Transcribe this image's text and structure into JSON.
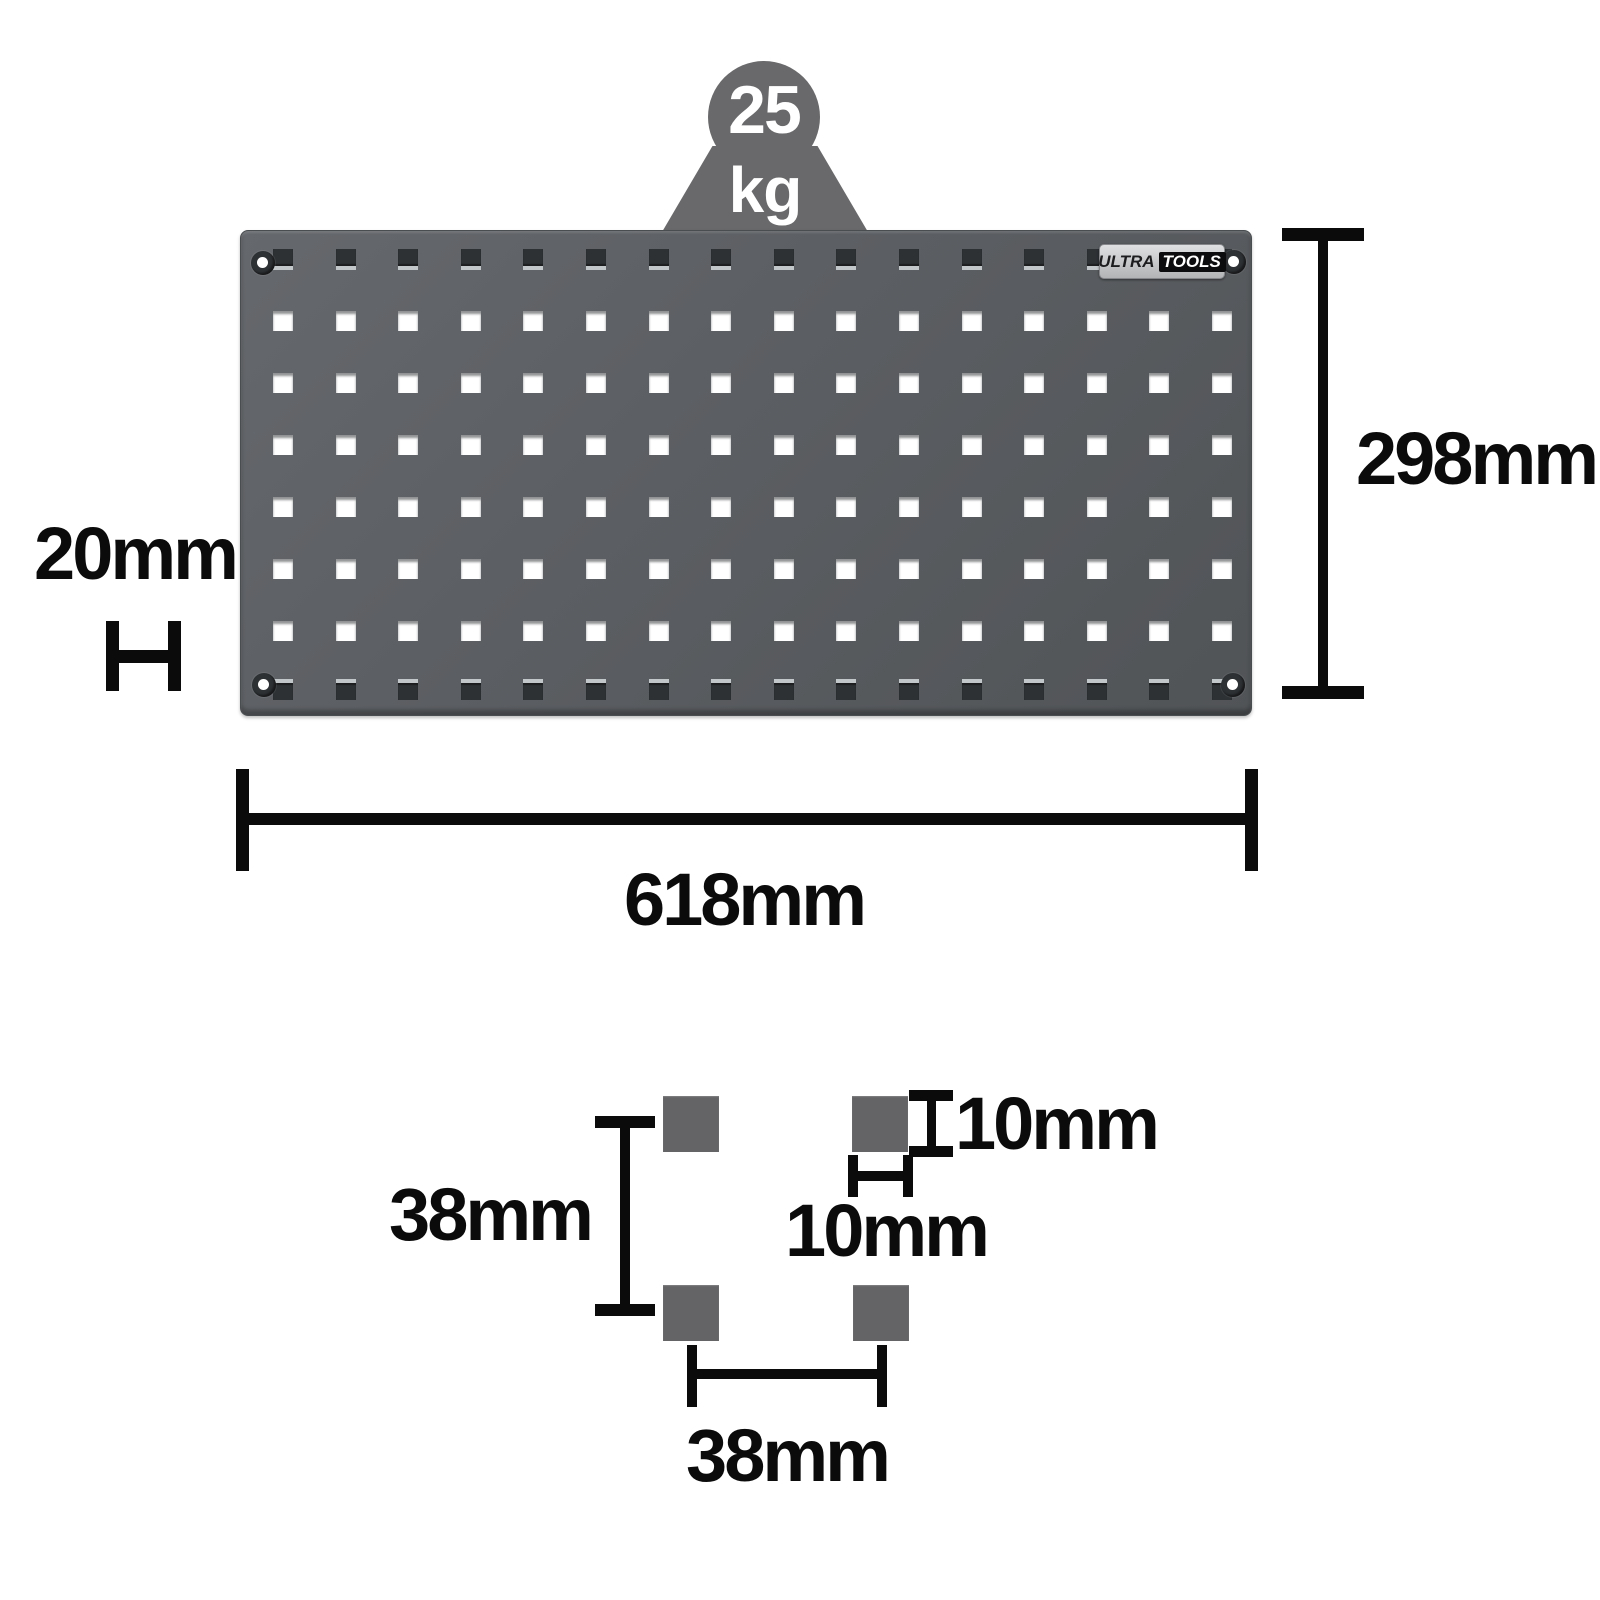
{
  "weight_badge": {
    "value": "25",
    "unit": "kg"
  },
  "brand_badge": {
    "part1": "ULTRA",
    "part2": "TOOLS"
  },
  "panel": {
    "rows": 8,
    "cols": 16,
    "dark_rows": [
      0,
      7
    ]
  },
  "dims": {
    "height": "298mm",
    "depth": "20mm",
    "width": "618mm",
    "v_spacing": "38mm",
    "hole_height": "10mm",
    "hole_width": "10mm",
    "h_spacing": "38mm"
  },
  "colors": {
    "panel": "#595d60",
    "hole_dark": "#2d3134",
    "hole_light": "#ffffff",
    "icon_gray": "#69696b",
    "dimension_lines": "#0b0b0b",
    "detail_square": "#646467",
    "badge_tools_bg": "#0c0c0e"
  }
}
